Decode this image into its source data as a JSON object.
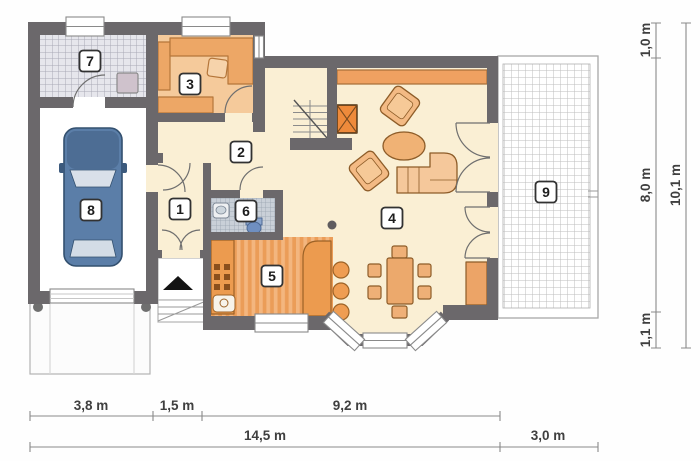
{
  "plan_title": "First floor plan",
  "room_labels": [
    "1",
    "2",
    "3",
    "4",
    "5",
    "6",
    "7",
    "8",
    "9"
  ],
  "dimensions": {
    "bottom_inner": [
      "3,8 m",
      "1,5 m",
      "9,2 m"
    ],
    "bottom_total": "14,5 m",
    "bottom_right": "3,0 m",
    "right_inner": [
      "1,0 m",
      "8,0 m",
      "1,1 m"
    ],
    "right_total": "10,1 m"
  },
  "palette": {
    "wall": "#6b686b",
    "floor_cream": "#faefd4",
    "floor_orange": "#f5ca9b",
    "kitchen_stripe_dark": "#eb9d58",
    "kitchen_stripe_light": "#f3b67f",
    "furniture_orange": "#eda766",
    "fireplace_orange": "#ee8a3b",
    "car_blue": "#5b7ea8",
    "tile_gray": "#e6e6ec",
    "wc_tile": "#c9d0d8",
    "dim_line": "#8a8a8a"
  }
}
